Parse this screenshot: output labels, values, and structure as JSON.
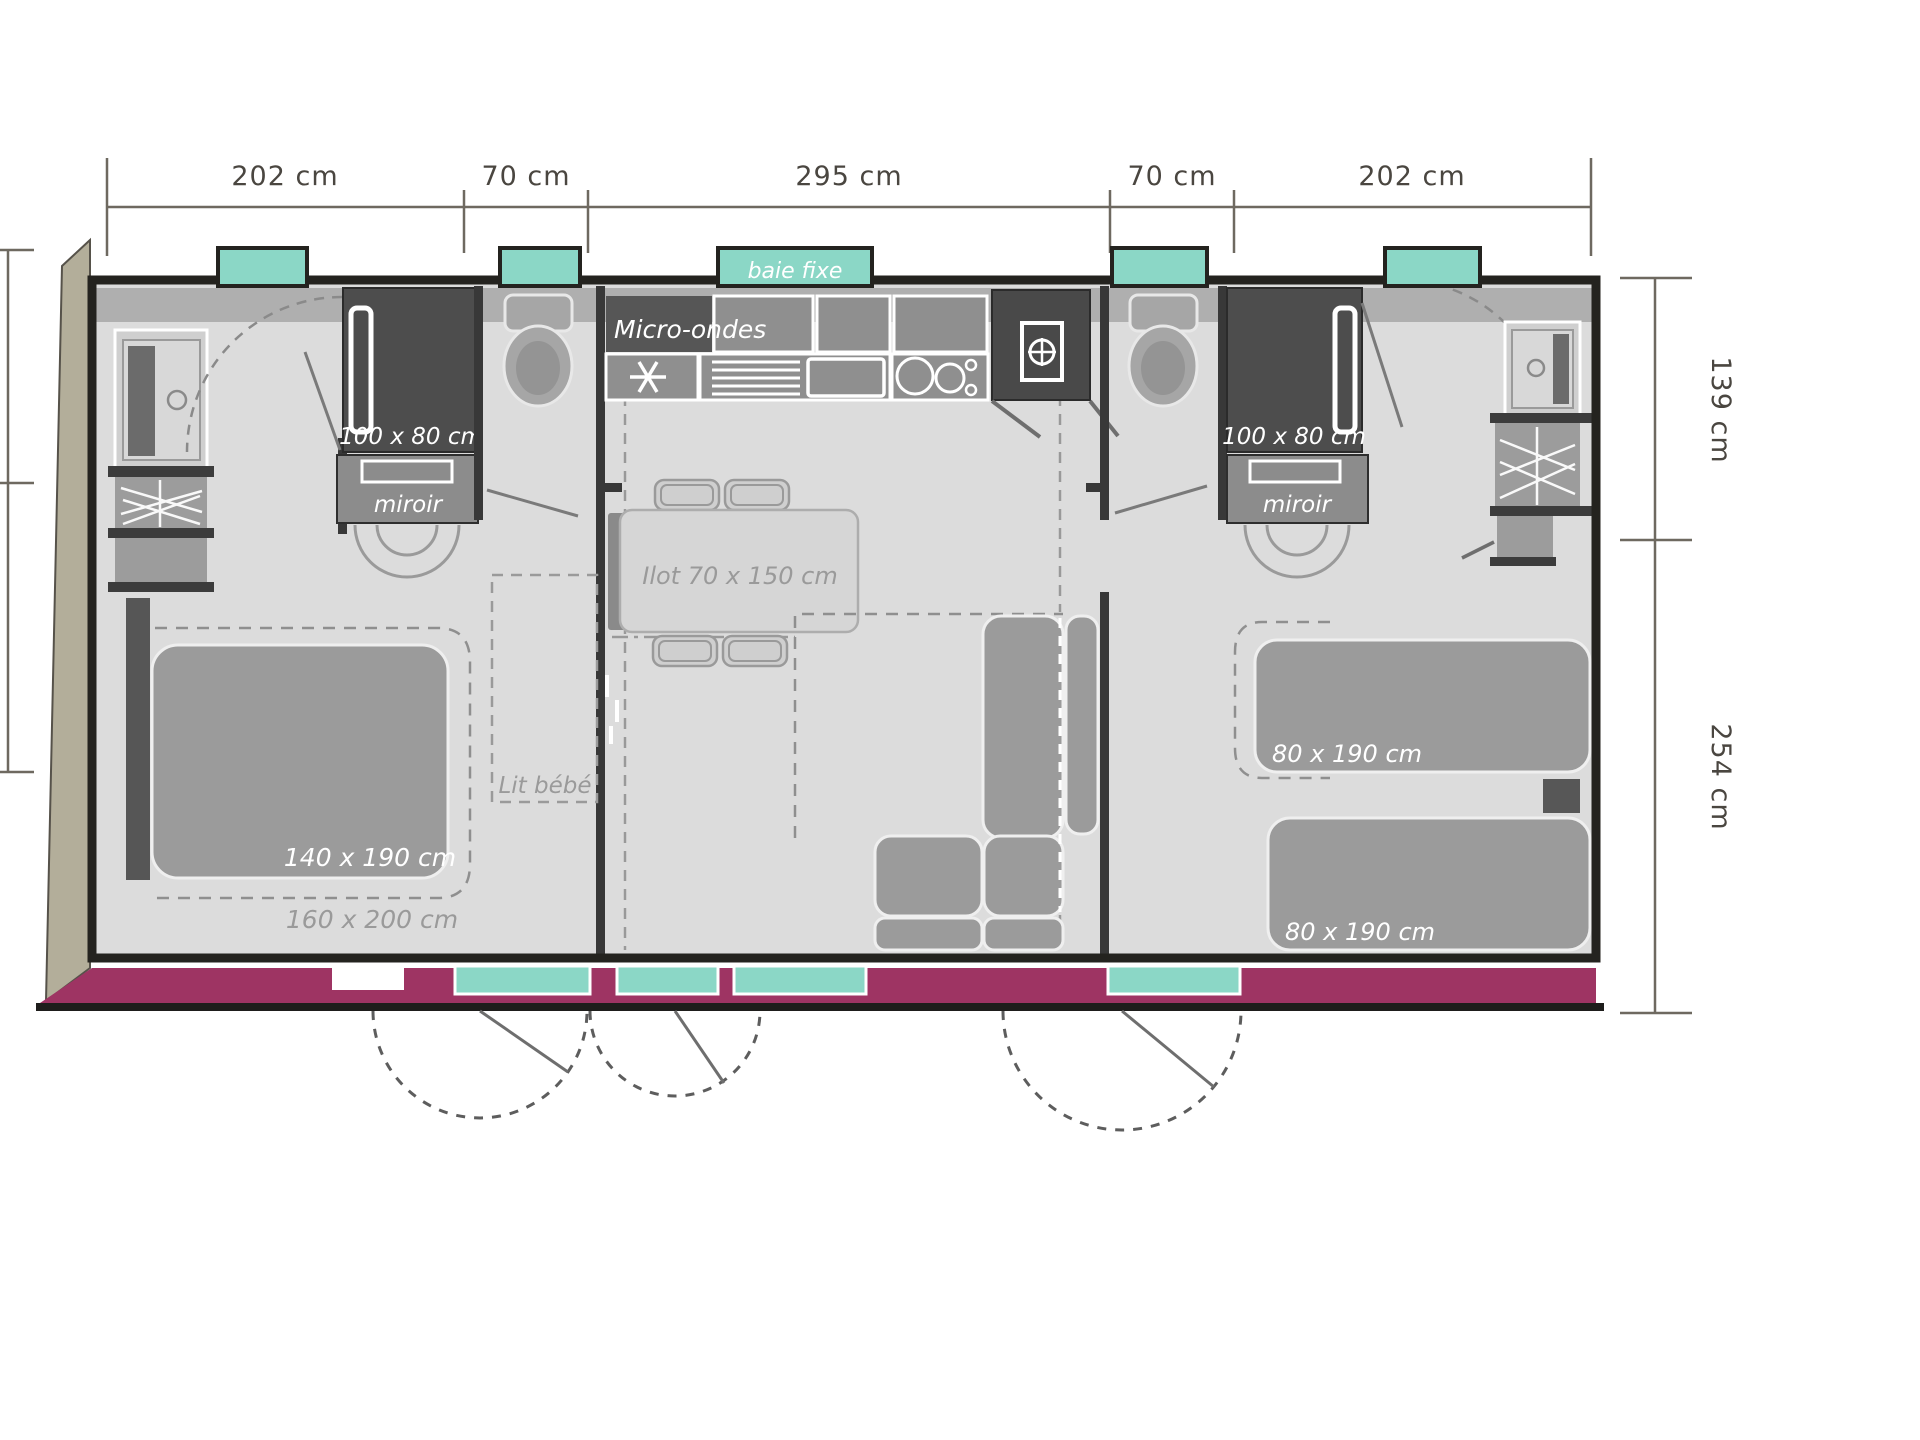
{
  "plan": {
    "title_hint": "mobile-home floor plan",
    "dims_top": [
      "202 cm",
      "70 cm",
      "295 cm",
      "70 cm",
      "202 cm"
    ],
    "dims_right": [
      "139 cm",
      "254 cm"
    ],
    "bay_window_label": "baie fixe",
    "kitchen": {
      "microwave_label": "Micro-ondes",
      "island_label": "Ilot 70 x 150 cm"
    },
    "bathroom_left": {
      "shower_label": "100 x 80 cm",
      "mirror_label": "miroir"
    },
    "bathroom_right": {
      "shower_label": "100 x 80 cm",
      "mirror_label": "miroir"
    },
    "bedroom_left": {
      "bed_label": "140 x 190 cm",
      "bed_alt_label": "160 x 200 cm",
      "crib_label": "Lit bébé"
    },
    "bedroom_right": {
      "bed1_label": "80 x 190 cm",
      "bed2_label": "80 x 190 cm"
    },
    "colors": {
      "window_teal": "#8bd7c6",
      "front_wall_magenta": "#9e3463",
      "side_wall_khaki": "#b3ae9a",
      "floor_gray": "#dcdcdc",
      "wall_dark": "#24231f"
    }
  }
}
